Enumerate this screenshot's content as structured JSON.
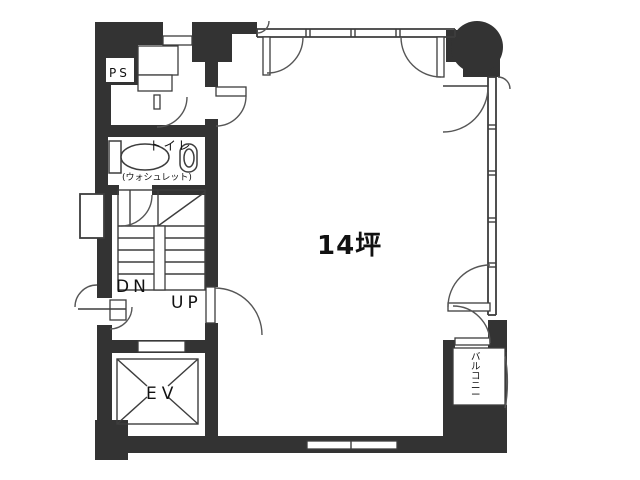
{
  "plan": {
    "area_label": "14坪",
    "labels": {
      "ps": "PS",
      "toilet": "トイレ",
      "toilet_note": "(ウォシュレット)",
      "stairs_down": "DN",
      "stairs_up": "UP",
      "elevator": "EV",
      "balcony": "バルコニー"
    },
    "colors": {
      "wall": "#333333",
      "line": "#3d3d3d",
      "door_line": "#565656",
      "text": "#111111",
      "background": "#ffffff"
    }
  }
}
